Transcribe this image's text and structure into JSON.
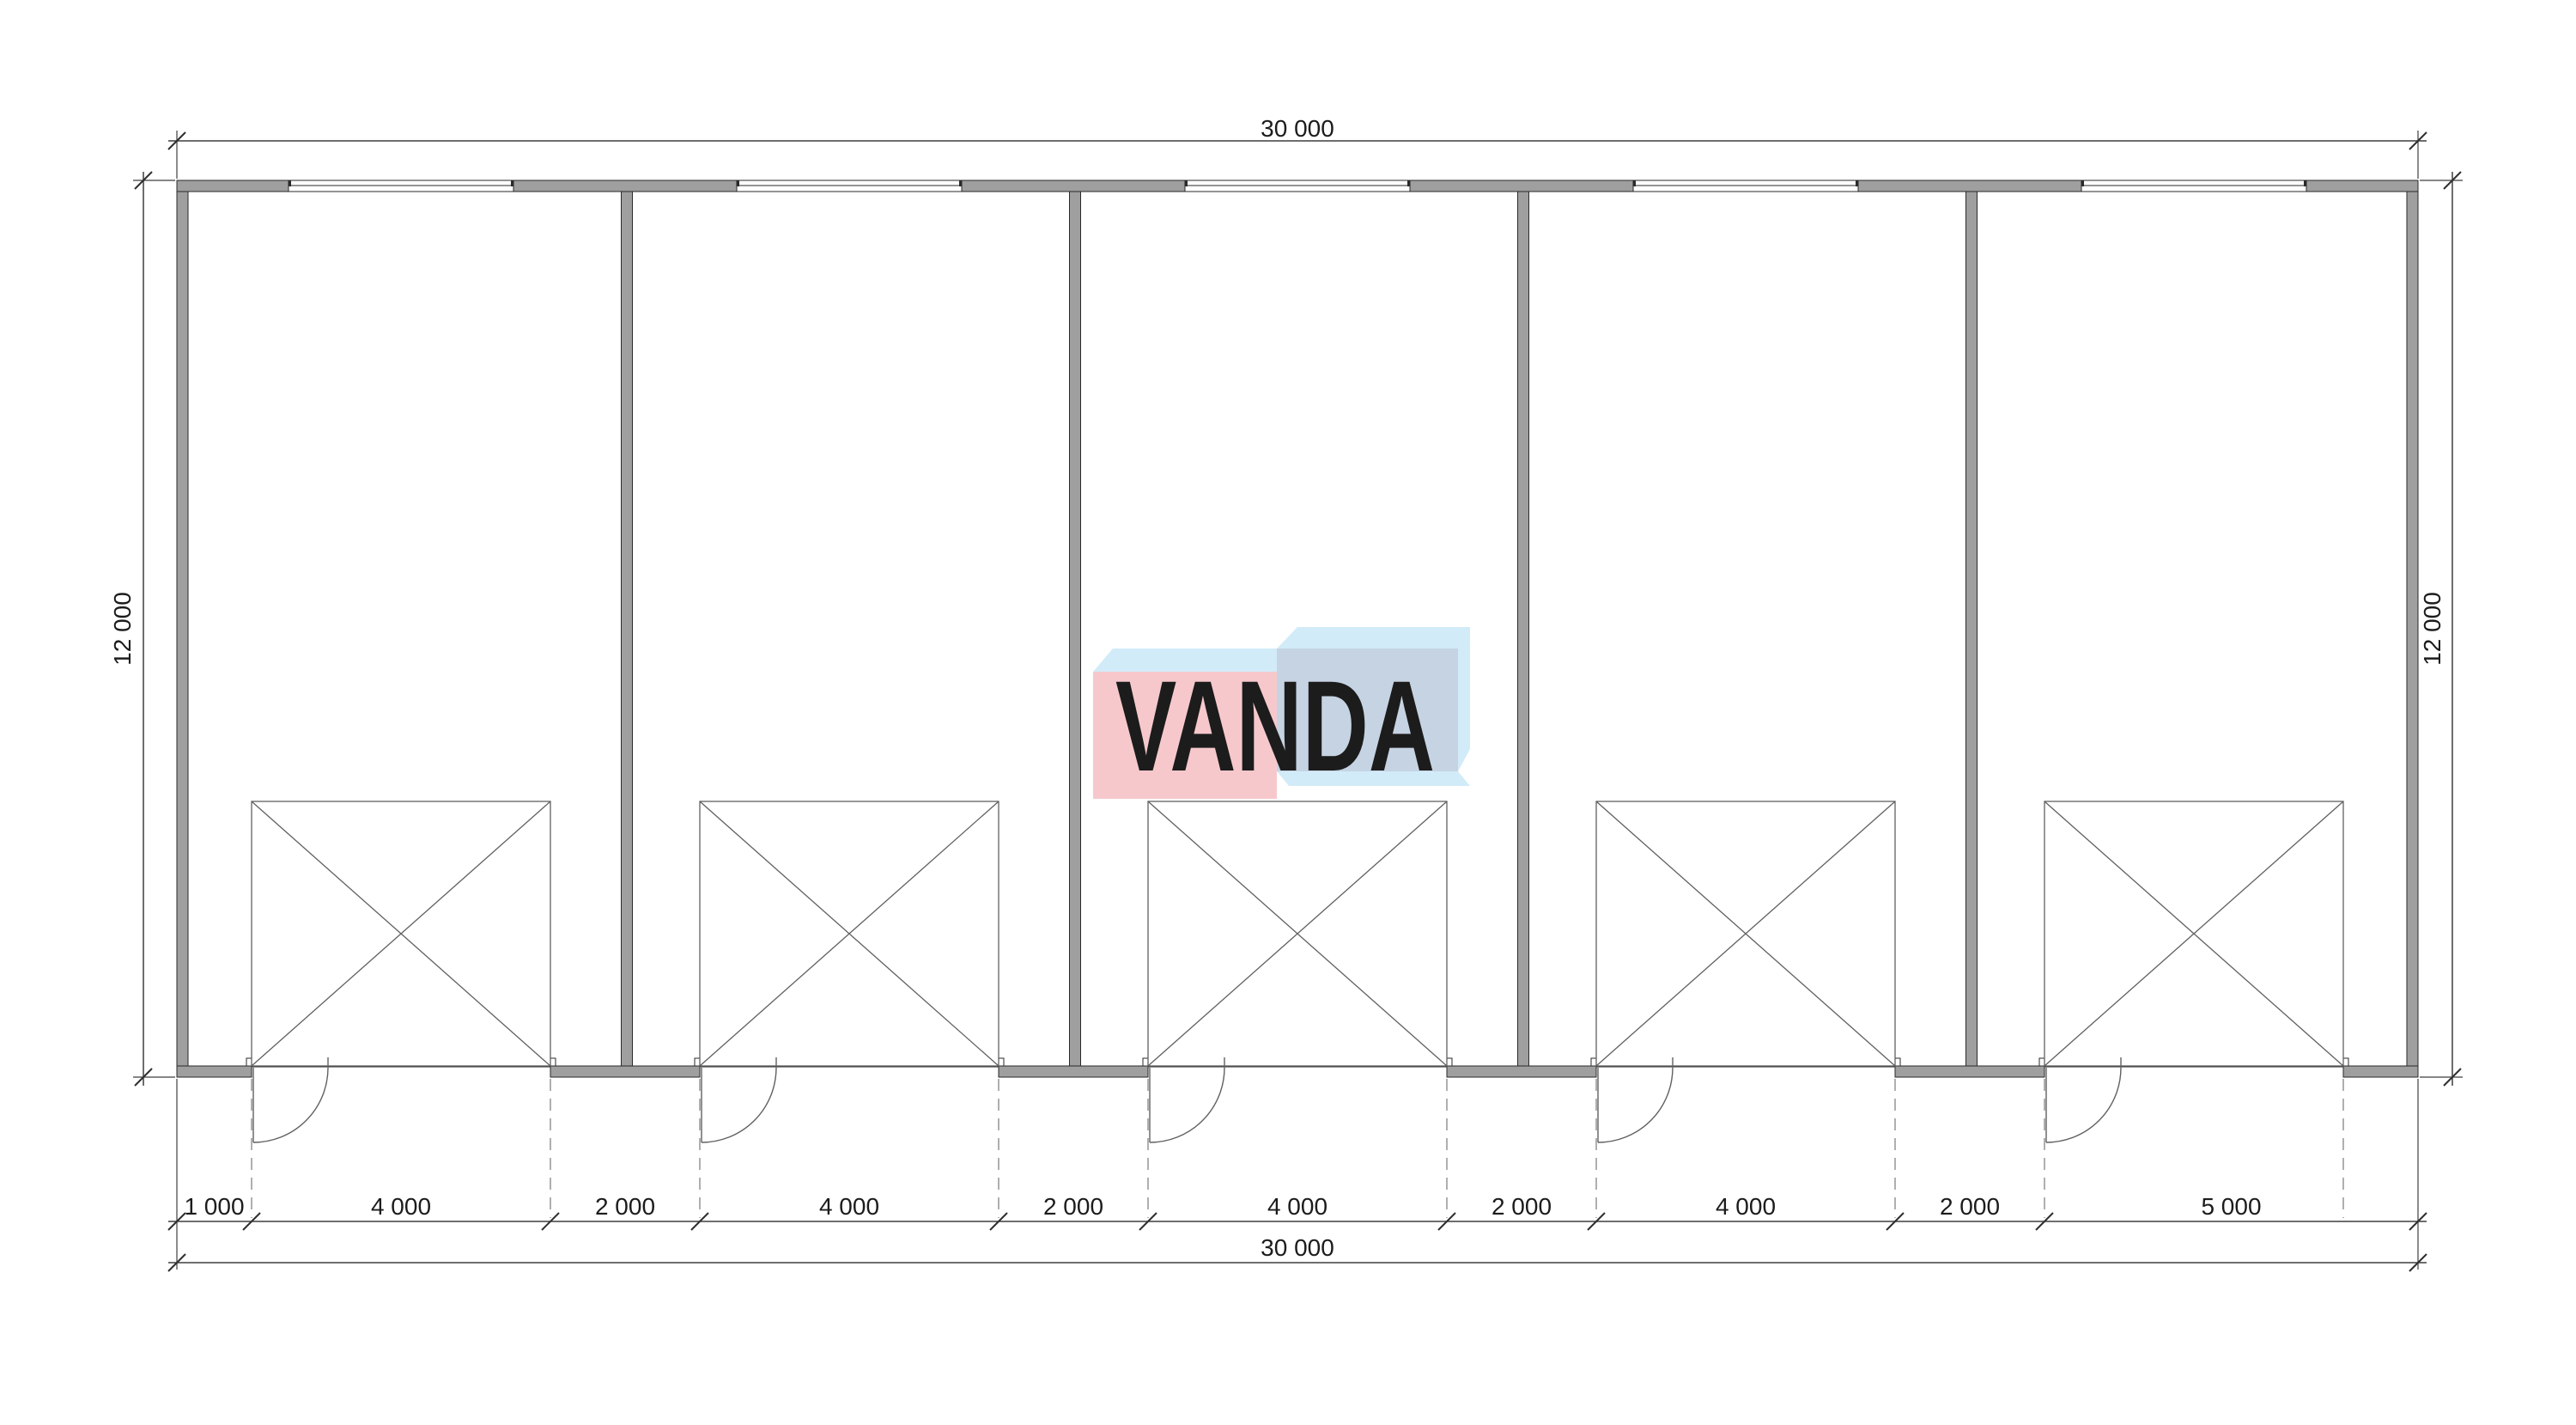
{
  "drawing": {
    "dimensions": {
      "top_total": "30 000",
      "bottom_total": "30 000",
      "left_height": "12 000",
      "right_height": "12 000",
      "bottom_segments": [
        "1 000",
        "4 000",
        "2 000",
        "4 000",
        "2 000",
        "4 000",
        "2 000",
        "4 000",
        "2 000",
        "5 000"
      ],
      "bottom_segments_mm": [
        1000,
        4000,
        2000,
        4000,
        2000,
        4000,
        2000,
        4000,
        2000,
        5000
      ],
      "total_width_mm": 30000,
      "total_height_mm": 12000
    },
    "plan": {
      "bay_count": 5,
      "opening_count": 5,
      "window_count": 5,
      "door_count": 5
    },
    "logo": {
      "text": "VANDA",
      "text_color": "#ffffff",
      "pink_front_color": "#f6c8cc",
      "cyan_face_color": "#d2ebf8",
      "blue_front_color": "#c6d3e3"
    },
    "colors": {
      "background": "#ffffff",
      "wall_fill": "#9f9f9f",
      "wall_outline": "#2a2a2a",
      "dimension_line": "#3f3f3f",
      "symbol_line": "#606060",
      "dashed_line": "#7a7a7a",
      "text": "#1c1c1c"
    }
  }
}
